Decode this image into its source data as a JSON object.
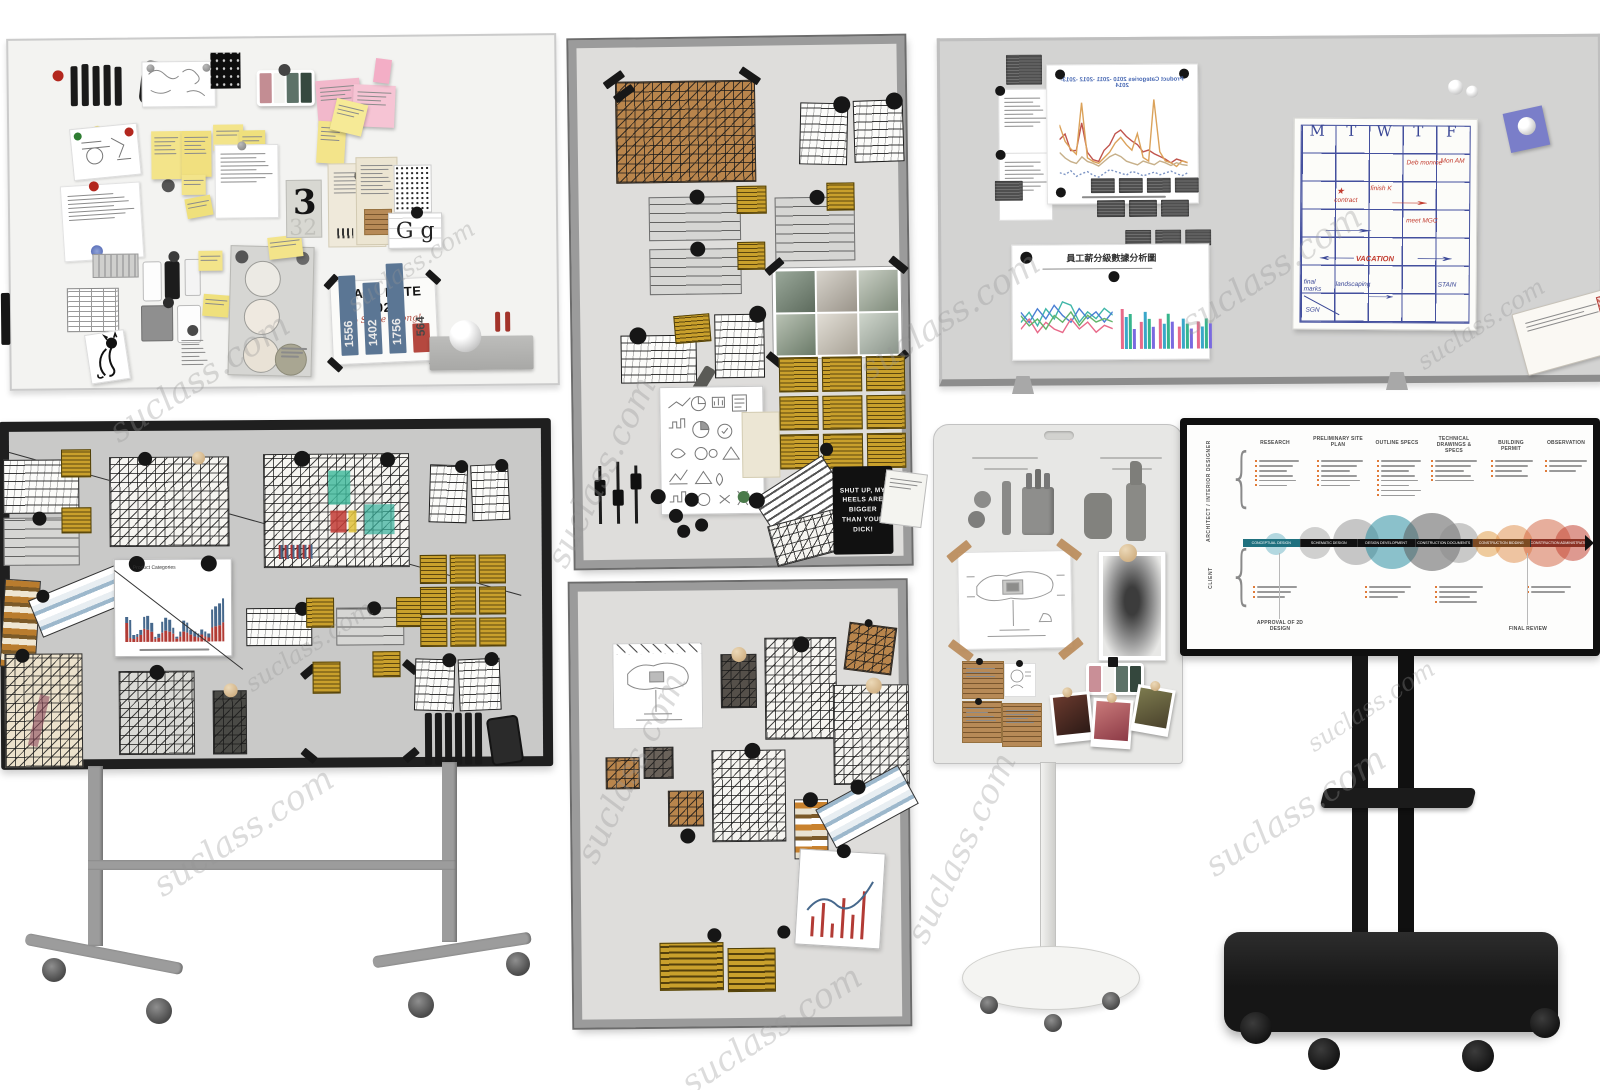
{
  "watermark": {
    "text": "suclass.com"
  },
  "b1": {
    "sale": {
      "title": "SALE RATE 2022",
      "note": "do Some wrong!"
    },
    "gg": "G g",
    "three_poster": {
      "primary": "3",
      "secondary": "32"
    }
  },
  "b3": {
    "quote": "SHUT UP, MY HEELS ARE BIGGER THAN YOUR DICK!"
  },
  "b5": {
    "line_title": "Product Categories 2010 -2011 -2012 -2013-2014",
    "cn_title": "員工薪分級數據分析圖",
    "cal": {
      "days": [
        "M",
        "T",
        "W",
        "T",
        "F"
      ],
      "notes": {
        "deb": "Deb monroe",
        "mon": "Mon AM",
        "star": "★",
        "contract": "contract",
        "finish": "finish K",
        "meet": "meet MGC",
        "vacation": "VACATION",
        "final": "final marks",
        "land": "landscaping",
        "stain": "STAIN",
        "sgn": "SGN"
      }
    }
  },
  "tv": {
    "laneA": "ARCHITECT / INTERIOR DESIGNER",
    "laneB": "CLIENT",
    "phases": [
      "RESEARCH",
      "PRELIMINARY SITE PLAN",
      "OUTLINE SPECS",
      "TECHNICAL DRAWINGS & SPECS",
      "BUILDING PERMIT",
      "OBSERVATION"
    ],
    "seg": [
      "CONCEPTUAL DESIGN",
      "SCHEMATIC DESIGN",
      "DESIGN DEVELOPMENT",
      "CONSTRUCTION DOCUMENTS",
      "CONSTRUCTION BIDDING",
      "CONSTRUCTION ADMINISTRATION"
    ],
    "footL": "APPROVAL OF 2D DESIGN",
    "footR": "FINAL REVIEW"
  },
  "chart_data": [
    {
      "id": "sale-rate-2022",
      "type": "bar",
      "title": "SALE RATE 2022",
      "annotation": "do Some wrong!",
      "categories": [
        "",
        "",
        "",
        ""
      ],
      "values": [
        1556,
        1402,
        1756,
        564
      ],
      "max": 1756,
      "colors": [
        "#5b7694",
        "#5b7694",
        "#5b7694",
        "#b5483f"
      ]
    },
    {
      "id": "product-categories-stacked",
      "type": "bar",
      "title": "Product Categories",
      "colors": [
        "#b23b35",
        "#46688c"
      ],
      "series": [
        {
          "name": "bottom",
          "values": [
            34,
            8,
            6,
            10,
            12,
            24,
            22,
            18,
            6,
            8,
            16,
            20,
            18,
            14,
            6,
            10,
            18,
            16,
            12,
            10,
            8,
            12,
            10,
            8,
            26,
            28,
            30,
            34
          ]
        },
        {
          "name": "top",
          "values": [
            12,
            32,
            6,
            4,
            10,
            22,
            26,
            16,
            4,
            6,
            20,
            24,
            22,
            12,
            4,
            8,
            20,
            18,
            10,
            8,
            6,
            10,
            8,
            6,
            32,
            36,
            40,
            44
          ]
        }
      ]
    },
    {
      "id": "product-categories-lines",
      "type": "line",
      "title": "Product Categories 2010 -2011 -2012 -2013-2014",
      "series": [
        {
          "name": "series-red",
          "color": "#c0544d",
          "values": [
            52,
            58,
            40,
            40,
            70,
            38,
            30,
            28,
            40,
            46,
            58,
            62,
            55,
            50,
            46,
            38,
            40,
            36,
            33,
            30,
            26,
            30,
            28,
            26
          ]
        },
        {
          "name": "series-orange",
          "color": "#dba25a",
          "values": [
            68,
            50,
            42,
            36,
            92,
            32,
            28,
            26,
            32,
            38,
            48,
            54,
            46,
            40,
            58,
            32,
            28,
            95,
            38,
            28,
            26,
            22,
            28,
            26
          ]
        },
        {
          "name": "series-tan",
          "color": "#c7b08a",
          "values": [
            38,
            32,
            28,
            26,
            33,
            28,
            26,
            23,
            28,
            33,
            36,
            33,
            28,
            26,
            24,
            28,
            26,
            24,
            28,
            26,
            23,
            26,
            24,
            23
          ]
        },
        {
          "name": "series-blue",
          "dash": true,
          "color": "#7d95c4",
          "values": [
            16,
            14,
            18,
            12,
            15,
            17,
            13,
            11,
            15,
            19,
            17,
            15,
            13,
            17,
            15,
            12,
            14,
            16,
            13,
            15,
            17,
            14,
            12,
            15
          ]
        }
      ]
    },
    {
      "id": "cn-dashboard",
      "type": "line+bar",
      "title": "員工薪分級數據分析圖",
      "line_series": [
        {
          "name": "teal",
          "color": "#3fb6a8",
          "values": [
            40,
            55,
            35,
            60,
            45,
            70,
            65,
            40,
            55,
            45,
            60,
            50
          ]
        },
        {
          "name": "blue",
          "color": "#4a7fd4",
          "values": [
            55,
            40,
            60,
            45,
            65,
            50,
            40,
            60,
            45,
            55,
            40,
            55
          ]
        },
        {
          "name": "pink",
          "color": "#e86a8a",
          "values": [
            30,
            45,
            25,
            40,
            30,
            25,
            45,
            30,
            40,
            25,
            35,
            30
          ]
        },
        {
          "name": "green",
          "color": "#62b36a",
          "values": [
            50,
            35,
            45,
            30,
            50,
            40,
            55,
            35,
            50,
            40,
            45,
            40
          ]
        }
      ],
      "bar_colors": [
        "#e86a8a",
        "#3aa7c9",
        "#37b58c",
        "#7a6ae0"
      ],
      "bar_groups": [
        [
          80,
          65,
          70,
          40
        ],
        [
          55,
          75,
          60,
          45
        ],
        [
          60,
          50,
          70,
          55
        ],
        [
          45,
          60,
          50,
          40
        ],
        [
          55,
          45,
          60,
          50
        ]
      ]
    }
  ]
}
